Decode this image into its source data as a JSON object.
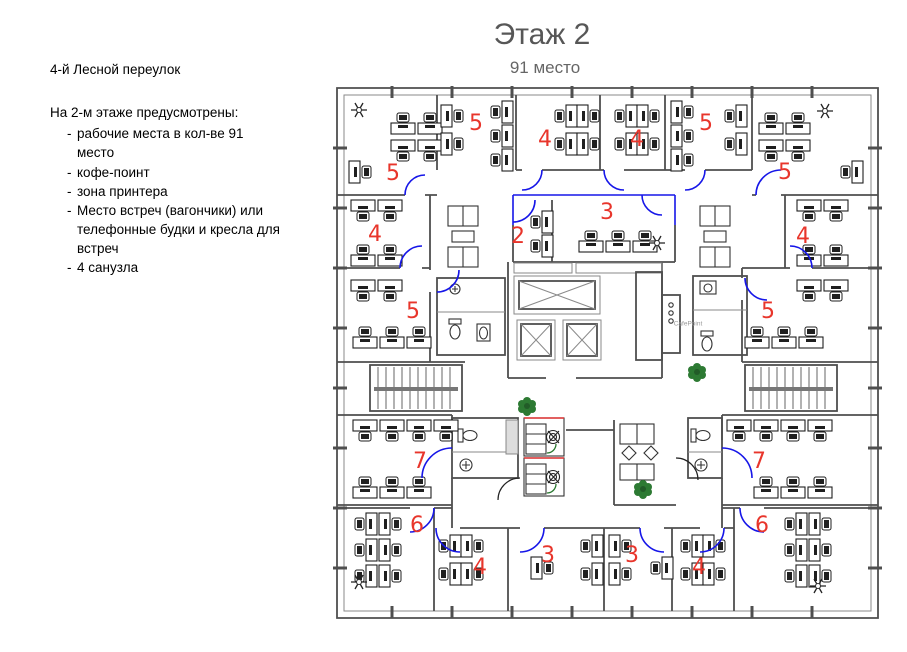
{
  "page": {
    "title": "Этаж 2",
    "subtitle": "91 место"
  },
  "notes": {
    "address": "4-й Лесной переулок",
    "intro": "На 2-м этаже предусмотрены:",
    "dash": "-",
    "bullets": [
      "рабочие места в кол-ве 91 место",
      "кофе-поинт",
      "зона принтера",
      "Место встреч (вагончики) или телефонные будки и кресла для встреч",
      "4 санузла"
    ]
  },
  "plan": {
    "cafepoint_label": "CafePoint",
    "zones": {
      "tl_corner": "5",
      "top_a": "5",
      "top_b": "4",
      "top_c": "4",
      "top_d": "5",
      "tr_corner": "5",
      "left_side": "4",
      "right_side": "4",
      "meeting_2": "2",
      "meeting_3": "3",
      "left_mid": "5",
      "right_mid": "5",
      "lower_left": "7",
      "lower_right": "7",
      "bottom_left": "6",
      "bottom_right": "6",
      "bottom_4l": "4",
      "bottom_3l": "3",
      "bottom_3r": "3",
      "bottom_4r": "4"
    },
    "colors": {
      "zone_label": "#e8352b",
      "door": "#1616e8",
      "plant": "#2d7a33",
      "wall": "#4f4f4f",
      "booth_accent_red": "#e03333"
    }
  }
}
